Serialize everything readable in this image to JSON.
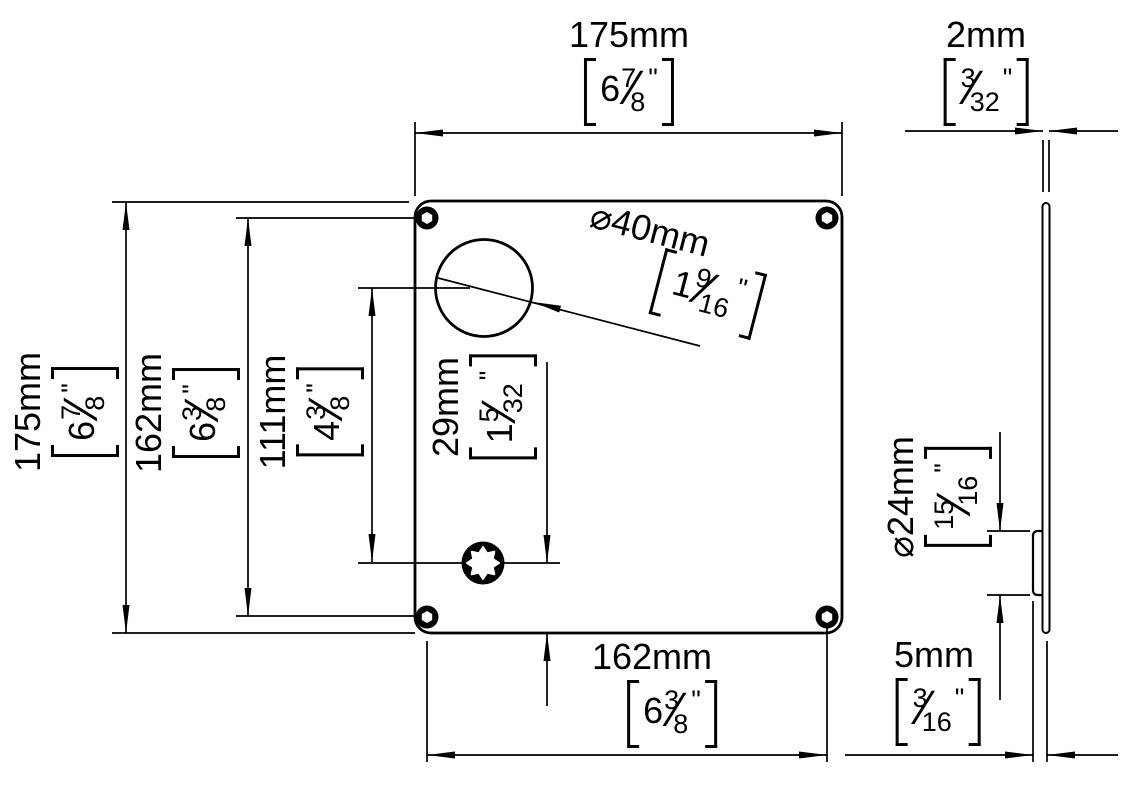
{
  "marks": {
    "inch": "\"",
    "slash": "⁄"
  },
  "labels": {
    "front_width": {
      "mm": "175mm",
      "whole": "6",
      "num": "7",
      "den": "8"
    },
    "front_height": {
      "mm": "175mm",
      "whole": "6",
      "num": "7",
      "den": "8"
    },
    "hole_spacing_v": {
      "mm": "162mm",
      "whole": "6",
      "num": "3",
      "den": "8"
    },
    "hole_spacing_h": {
      "mm": "162mm",
      "whole": "6",
      "num": "3",
      "den": "8"
    },
    "center_distance": {
      "mm": "111mm",
      "whole": "4",
      "num": "3",
      "den": "8"
    },
    "torx_edge_offset": {
      "mm": "29mm",
      "whole": "1",
      "num": "5",
      "den": "32"
    },
    "large_hole_diameter": {
      "mm": "⌀40mm",
      "whole": "1",
      "num": "9",
      "den": "16"
    },
    "plate_thickness": {
      "mm": "2mm",
      "num": "3",
      "den": "32"
    },
    "boss_diameter": {
      "mm": "⌀24mm",
      "num": "15",
      "den": "16"
    },
    "boss_total_depth": {
      "mm": "5mm",
      "num": "3",
      "den": "16"
    }
  }
}
